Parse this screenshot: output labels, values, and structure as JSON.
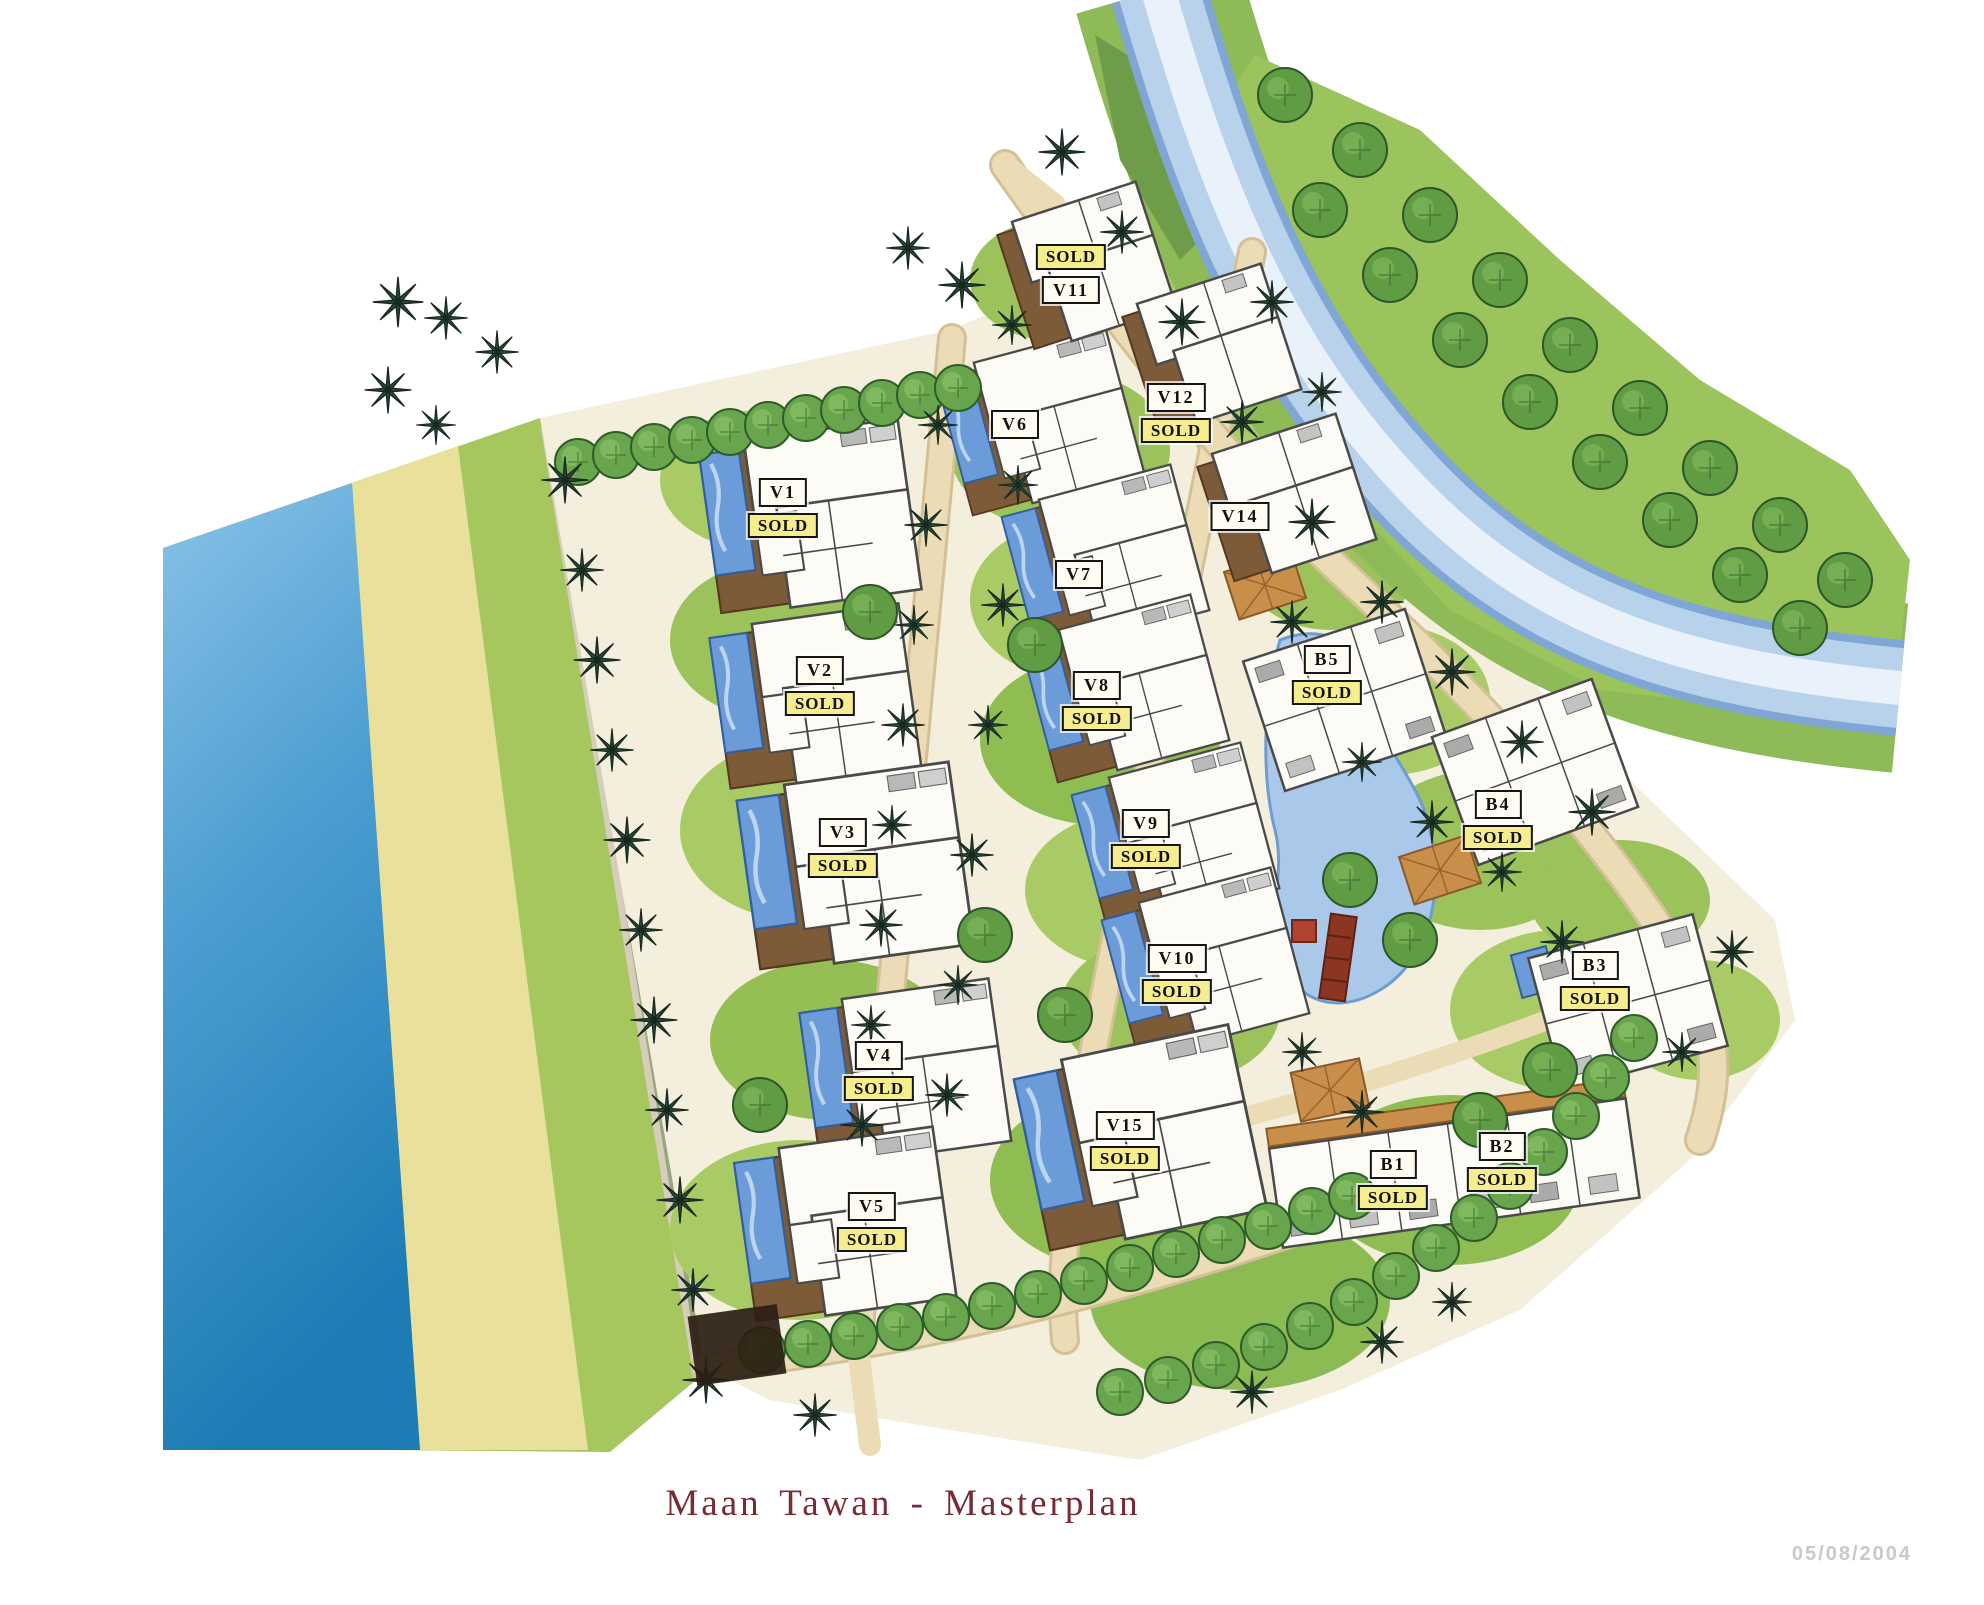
{
  "title": "Maan Tawan - Masterplan",
  "date_stamp": "05/08/2004",
  "labels": {
    "sold": "SOLD"
  },
  "plots": [
    {
      "id": "V1",
      "sold": true,
      "sold_position": "below",
      "x": 783,
      "y": 478
    },
    {
      "id": "V2",
      "sold": true,
      "sold_position": "below",
      "x": 820,
      "y": 656
    },
    {
      "id": "V3",
      "sold": true,
      "sold_position": "below",
      "x": 843,
      "y": 818
    },
    {
      "id": "V4",
      "sold": true,
      "sold_position": "below",
      "x": 879,
      "y": 1041
    },
    {
      "id": "V5",
      "sold": true,
      "sold_position": "below",
      "x": 872,
      "y": 1192
    },
    {
      "id": "V6",
      "sold": false,
      "sold_position": "none",
      "x": 1015,
      "y": 410
    },
    {
      "id": "V7",
      "sold": false,
      "sold_position": "none",
      "x": 1079,
      "y": 560
    },
    {
      "id": "V8",
      "sold": true,
      "sold_position": "below",
      "x": 1097,
      "y": 671
    },
    {
      "id": "V9",
      "sold": true,
      "sold_position": "below",
      "x": 1146,
      "y": 809
    },
    {
      "id": "V10",
      "sold": true,
      "sold_position": "below",
      "x": 1177,
      "y": 944
    },
    {
      "id": "V11",
      "sold": true,
      "sold_position": "above",
      "x": 1071,
      "y": 244
    },
    {
      "id": "V12",
      "sold": true,
      "sold_position": "below",
      "x": 1176,
      "y": 383
    },
    {
      "id": "V14",
      "sold": false,
      "sold_position": "none",
      "x": 1240,
      "y": 502
    },
    {
      "id": "V15",
      "sold": true,
      "sold_position": "below",
      "x": 1125,
      "y": 1111
    },
    {
      "id": "B1",
      "sold": true,
      "sold_position": "below",
      "x": 1393,
      "y": 1150
    },
    {
      "id": "B2",
      "sold": true,
      "sold_position": "below",
      "x": 1502,
      "y": 1132
    },
    {
      "id": "B3",
      "sold": true,
      "sold_position": "below",
      "x": 1595,
      "y": 951
    },
    {
      "id": "B4",
      "sold": true,
      "sold_position": "below",
      "x": 1498,
      "y": 790
    },
    {
      "id": "B5",
      "sold": true,
      "sold_position": "below",
      "x": 1327,
      "y": 645
    }
  ],
  "colors": {
    "sea_light": "#8ac3e8",
    "sea_dark": "#1d7cb4",
    "sand": "#e9e09c",
    "grass": "#a5c75d",
    "river": "#b9d2ec",
    "river_edge": "#7fa6d4",
    "canopy": "#69a54c",
    "palm": "#2d493a",
    "pool": "#6b9bd8",
    "deck": "#7d5b38",
    "road": "#ecdcb6",
    "building": "#fcfbf5",
    "sold_bg": "#f6ee8e",
    "tag_bg": "#fffdf2",
    "title_color": "#7a2a33",
    "date_color": "#c9c9c9",
    "bridge_red": "#8c3520"
  }
}
